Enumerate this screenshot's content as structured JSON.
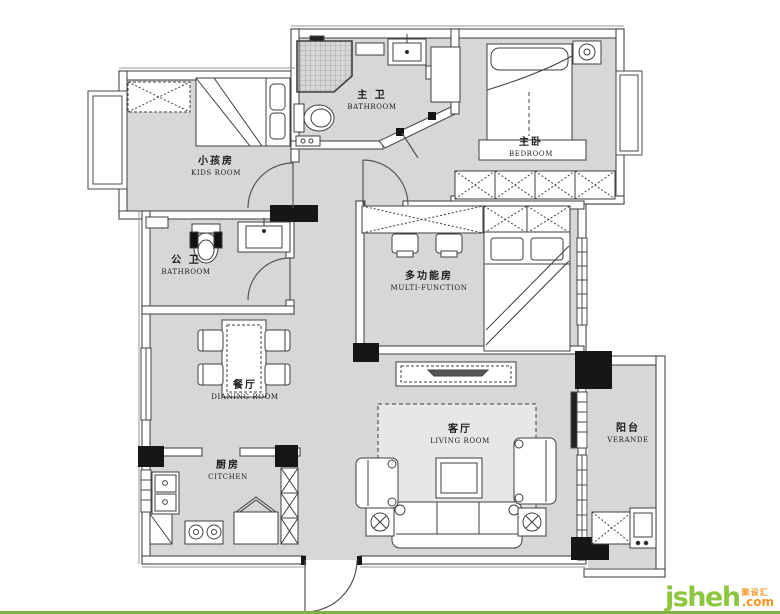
{
  "rooms": [
    {
      "id": "kids-room",
      "zh": "小孩房",
      "en": "KIDS ROOM"
    },
    {
      "id": "master-bathroom",
      "zh": "主 卫",
      "en": "BATHROOM"
    },
    {
      "id": "master-bedroom",
      "zh": "主卧",
      "en": "BEDROOM"
    },
    {
      "id": "public-bathroom",
      "zh": "公 卫",
      "en": "BATHROOM"
    },
    {
      "id": "multi-function",
      "zh": "多功能房",
      "en": "MULTI-FUNCTION"
    },
    {
      "id": "dining-room",
      "zh": "餐厅",
      "en": "DIANING ROOM"
    },
    {
      "id": "kitchen",
      "zh": "厨房",
      "en": "CITCHEN"
    },
    {
      "id": "living-room",
      "zh": "客厅",
      "en": "LIVING ROOM"
    },
    {
      "id": "veranda",
      "zh": "阳台",
      "en": "VERANDE"
    }
  ],
  "watermark": {
    "brand": "jsheh",
    "tld": ".com",
    "cn": "聚设汇"
  },
  "colors": {
    "floor": "#d7d7d7",
    "wall": "#4a4a4a",
    "pier": "#161616",
    "logo_green": "#8dc63f",
    "logo_orange": "#f7941e",
    "footer_green": "#7db343"
  }
}
